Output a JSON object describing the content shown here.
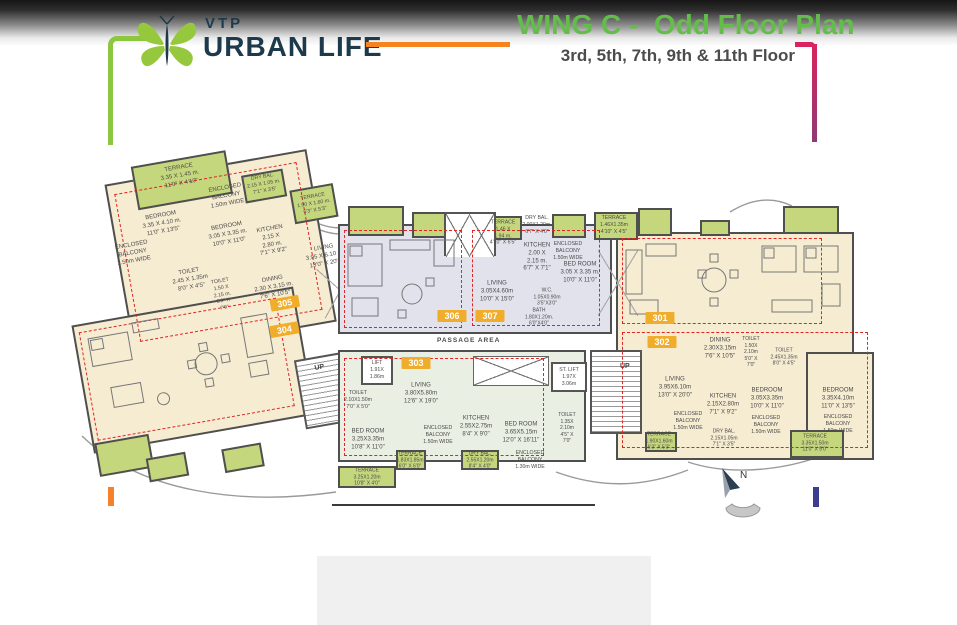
{
  "header": {
    "brand_top": "VTP",
    "brand_name": "URBAN LIFE",
    "title": "WING C -  Odd Floor Plan",
    "subtitle": "3rd, 5th, 7th, 9th & 11th Floor"
  },
  "plan": {
    "passage_label": "PASSAGE AREA",
    "up_label": "UP",
    "north_label": "N",
    "badges": {
      "u301": "301",
      "u302": "302",
      "u303": "303",
      "u304": "304",
      "u305": "305",
      "u306": "306",
      "u307": "307"
    },
    "labels": {
      "r305_terrace_top": "TERRACE\n3.35 X 1.45 m.\n11'0\" X 4'10\"",
      "r305_bedroom1": "BEDROOM\n3.35 X 4.10 m.\n11'0\" X 13'5\"",
      "r305_encbal_top": "ENCLOSED\nBALCONY\n1.50m WIDE",
      "r305_bedroom2": "BEDROOM\n3.05 X 3.35 m.\n10'0\" X 11'0\"",
      "r305_drybal": "DRY BAL.\n2.15 X 1.05 m.\n7'1\" X 3'5\"",
      "r305_kitchen": "KITCHEN\n2.15 X\n2.80 m.\n7'1\" X 9'2\"",
      "r305_terrace_right": "TERRACE\n1.90 X 1.60 m.\n6'3\" X 5'3\"",
      "r305_encbal_left": "ENCLOSED\nBALCONY\n1.50m WIDE",
      "r305_toilet1": "TOILET\n2.45 X 1.35m\n8'0\" X 4'5\"",
      "r305_toilet2": "TOILET\n1.50 X\n2.15 m.\n5'0\" X\n7'0\"",
      "r305_dining": "DINING\n2.30 X 3.15 m.\n7'6\" X 10'5\"",
      "r305_living": "LIVING\n3.95 X 6.10 m.\n13'0\" X 20'0\"",
      "r307_terrace_left": "TERRACE\n1.46 X\n1.94 m.\n4'10\" X 6'5\"",
      "r307_drybal": "DRY BAL.\n2.00X1.20m.\n6'7\" X 4'0\"",
      "r307_terrace_right": "TERRACE\n1.46X1.35m\n4'10\" X 4'5\"",
      "r307_kitchen": "KITCHEN\n2.00 X\n2.15 m.\n6'7\" X 7'1\"",
      "r307_encbal": "ENCLOSED\nBALCONY\n1.50m WIDE",
      "r307_bedroom": "BED ROOM\n3.05 X 3.35 m.\n10'0\" X 11'0\"",
      "r307_living": "LIVING\n3.05X4.60m\n10'0\" X 15'0\"",
      "r307_wc": "W.C.\n1.05X0.90m\n3'5\"X3'0\"",
      "r307_bath": "BATH\n1.80X1.20m.\n6'0\"X4'0\"",
      "r303_lift": "LIFT\n1.91X\n1.86m",
      "r303_stlift": "ST. LIFT\n1.97X\n3.06m",
      "r303_living": "LIVING\n3.80X5.80m\n12'6\" X 19'0\"",
      "r303_toilet_left": "TOILET\n2.10X1.50m\n7'0\" X 5'0\"",
      "r303_bedroom_left": "BED ROOM\n3.25X3.35m\n10'8\" X 11'0\"",
      "r303_encbal": "ENCLOSED\nBALCONY\n1.50m WIDE",
      "r303_kitchen": "KITCHEN\n2.55X2.75m\n8'4\" X 9'0\"",
      "r303_bedroom_right": "BED ROOM\n3.65X5.15m\n12'0\" X 16'11\"",
      "r303_terrace_mid": "TERRACE\n1.83X1.85m\n6'0\" X 6'0\"",
      "r303_terrace_bl": "TERRACE\n3.25X1.20m\n10'8\" X 4'0\"",
      "r303_drybal": "DRY BAL.\n2.55X1.20m\n8'4\" X 4'0\"",
      "r303_encbal2": "ENCLOSED\nBALCONY\n1.30m WIDE",
      "r303_toilet_right": "TOILET\n1.35X\n2.10m\n4'5\" X\n7'0\"",
      "r302_dining": "DINING\n2.30X3.15m\n7'6\" X 10'5\"",
      "r302_toilet_sm": "TOILET\n1.50X\n2.10m\n5'0\" X\n7'0\"",
      "r302_toilet_w": "TOILET\n2.45X1.35m\n8'0\" X 4'5\"",
      "r302_living": "LIVING\n3.95X6.10m\n13'0\" X 20'0\"",
      "r302_kitchen": "KITCHEN\n2.15X2.80m\n7'1\" X 9'2\"",
      "r302_bedroom_m": "BEDROOM\n3.05X3.35m\n10'0\" X 11'0\"",
      "r302_bedroom_r": "BEDROOM\n3.35X4.10m\n11'0\" X 13'5\"",
      "r302_encbal_l": "ENCLOSED\nBALCONY\n1.50m WIDE",
      "r302_encbal_m": "ENCLOSED\nBALCONY\n1.50m WIDE",
      "r302_encbal_r": "ENCLOSED\nBALCONY\n1.50m WIDE",
      "r302_drybal": "DRY BAL.\n2.15X1.05m\n7'1\" X 3'5\"",
      "r302_terrace_l": "TERRACE\n1.90X1.60m\n6'3\" X 5'3\"",
      "r302_terrace_r": "TERRACE\n3.35X1.50m\n11'0\" X 5'0\""
    }
  },
  "colors": {
    "title_green": "#64bd4a",
    "orange_accent": "#f5831f",
    "pink_accent": "#d9245f",
    "brand_navy": "#1c3a4b",
    "badge_yellow": "#f0ad2b",
    "terrace_green": "#c5d77d",
    "unit_cream": "#f6ecd2",
    "unit_lavender": "#e2e2ec",
    "unit_lightgreen": "#e9f0e3",
    "carpet_dash_red": "#e02525"
  }
}
